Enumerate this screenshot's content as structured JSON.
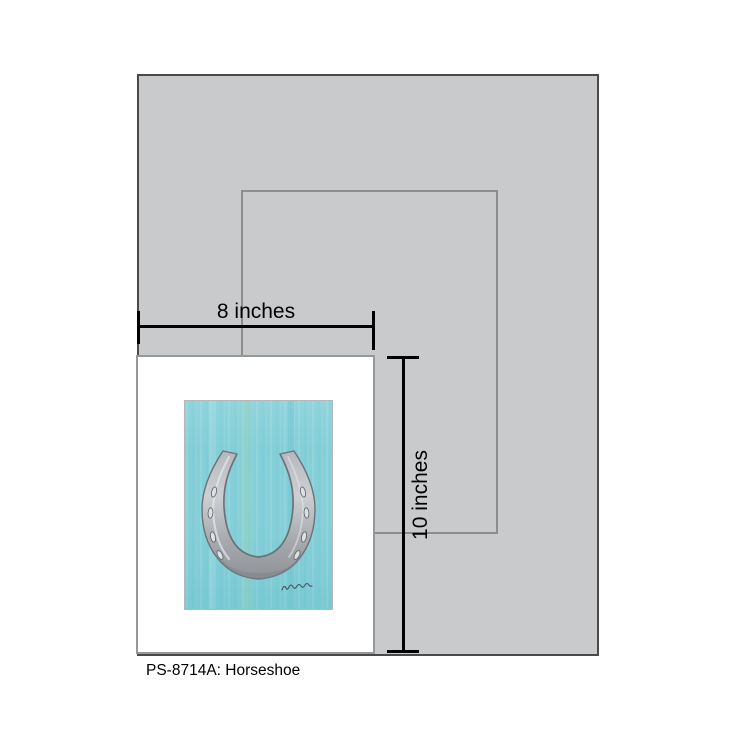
{
  "caption": "PS-8714A: Horseshoe",
  "dimensions": {
    "width_label": "8 inches",
    "height_label": "10 inches"
  },
  "artwork": {
    "subject": "horseshoe-painting"
  },
  "colors": {
    "page_background": "#ffffff",
    "wall_panel": "#c9cacb",
    "wall_border": "#4a4a4a",
    "size_outline": "#8d8d8d",
    "paper": "#ffffff",
    "paper_border": "#96999b",
    "dimension_lines": "#000000",
    "artwork_teal": "#7ecdd6",
    "artwork_green_streak": "#9fd8b9",
    "horseshoe_light": "#cdcfd2",
    "horseshoe_mid": "#aaaeb3",
    "horseshoe_dark": "#8f9398",
    "horseshoe_outline": "#6d7278",
    "signature": "#4a545c"
  }
}
